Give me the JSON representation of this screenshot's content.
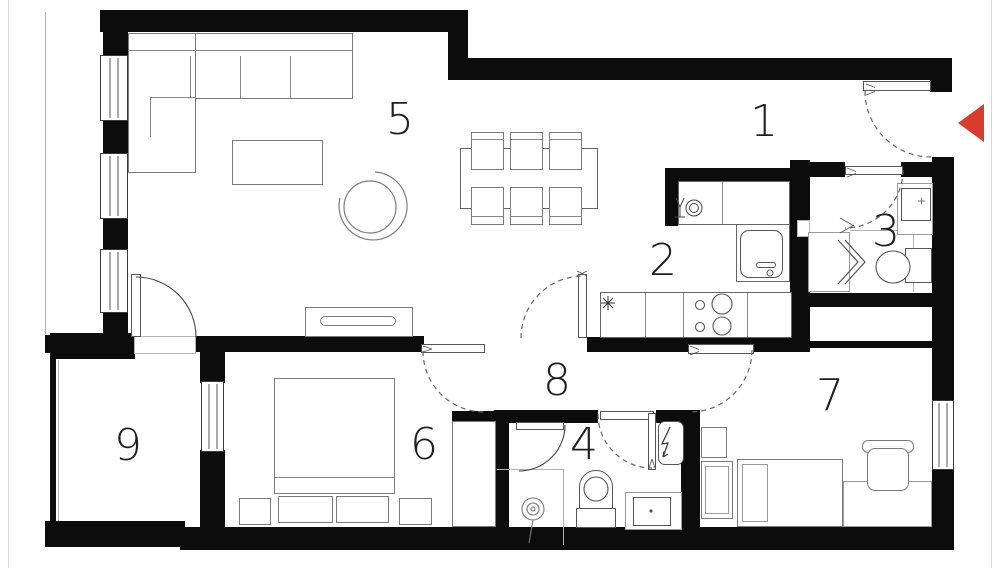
{
  "floorplan": {
    "rooms": [
      {
        "label": "1"
      },
      {
        "label": "2"
      },
      {
        "label": "3"
      },
      {
        "label": "4"
      },
      {
        "label": "5"
      },
      {
        "label": "6"
      },
      {
        "label": "7"
      },
      {
        "label": "8"
      },
      {
        "label": "9"
      }
    ],
    "colors": {
      "wall": "#0c0c0c",
      "furniture_line": "#7b7b7b",
      "door_arc": "#666666",
      "entrance_arrow": "#d93b2f",
      "page_edge": "#d8d8d8"
    },
    "icons": {
      "entrance_arrow": "left-triangle",
      "dishwasher": "glass-and-plate",
      "hob": "asterisk",
      "water_heater": "lightning-bolt",
      "shower_head": "concentric-circles",
      "shower_door": "zigzag-chevrons"
    }
  }
}
